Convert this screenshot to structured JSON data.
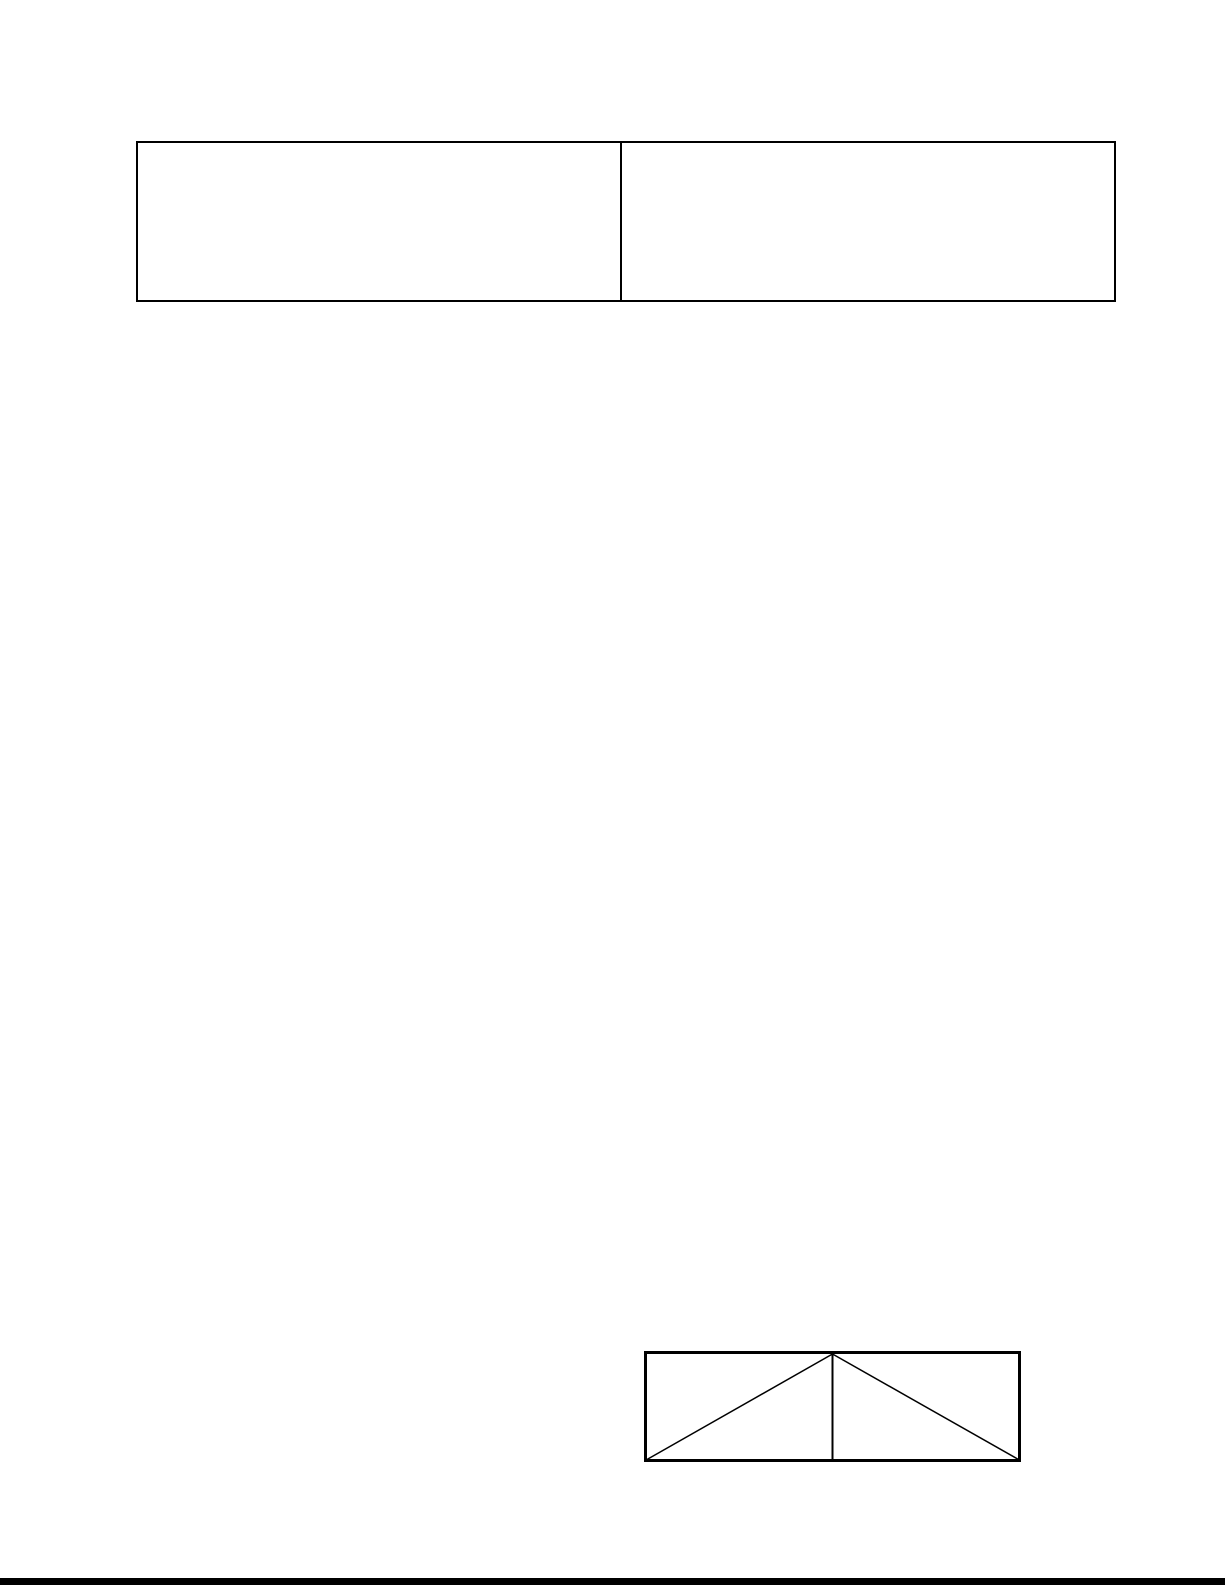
{
  "page": {
    "background_color": "#ffffff",
    "line_color": "#000000"
  },
  "table": {
    "rows": 1,
    "columns": 2,
    "cells": [
      {
        "text": ""
      },
      {
        "text": ""
      }
    ]
  },
  "drawing": {
    "shape_name": "split-rectangle-with-diagonals",
    "line_color": "#000000"
  },
  "bottom_strip": {
    "color": "#000000"
  }
}
